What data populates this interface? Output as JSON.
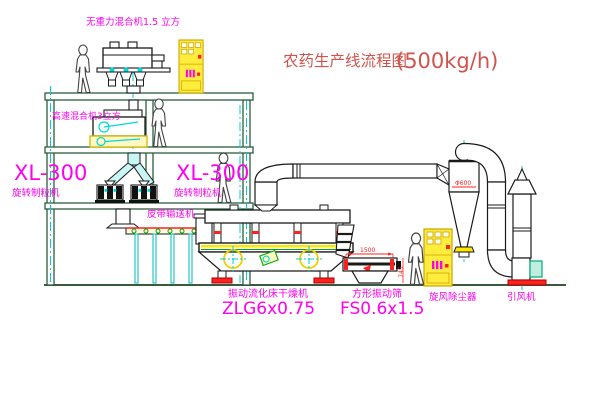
{
  "title": {
    "text": "农药生产线流程图",
    "capacity": "(500kg/h)"
  },
  "equipment_labels": {
    "top_mixer": "无重力混合机1.5 立方",
    "high_speed_mixer": "高速混合机3立方",
    "granulator_left_model": "XL-300",
    "granulator_left_name": "旋转制粒机",
    "granulator_right_model": "XL-300",
    "granulator_right_name": "旋转制粒机",
    "belt_conveyor": "皮带输送机",
    "dryer_name": "振动流化床干燥机",
    "dryer_model": "ZLG6x0.75",
    "screen_name": "方形振动筛",
    "screen_model": "FS0.6x1.5",
    "cyclone": "旋风除尘器",
    "induced_draft_fan": "引风机"
  },
  "dimension_annotations": {
    "cyclone_diameter": "Φ600",
    "screen_length": "1500",
    "screen_height": "745"
  },
  "colors": {
    "label_magenta": "#ff00f0",
    "title_red": "#d0544c",
    "dimension_red": "#ff2020",
    "structure_green": "#2b5d3b",
    "centerline_cyan": "#00cccc",
    "cabinet_yellow": "#ffec3d",
    "equipment_black": "#1a1a1a"
  }
}
